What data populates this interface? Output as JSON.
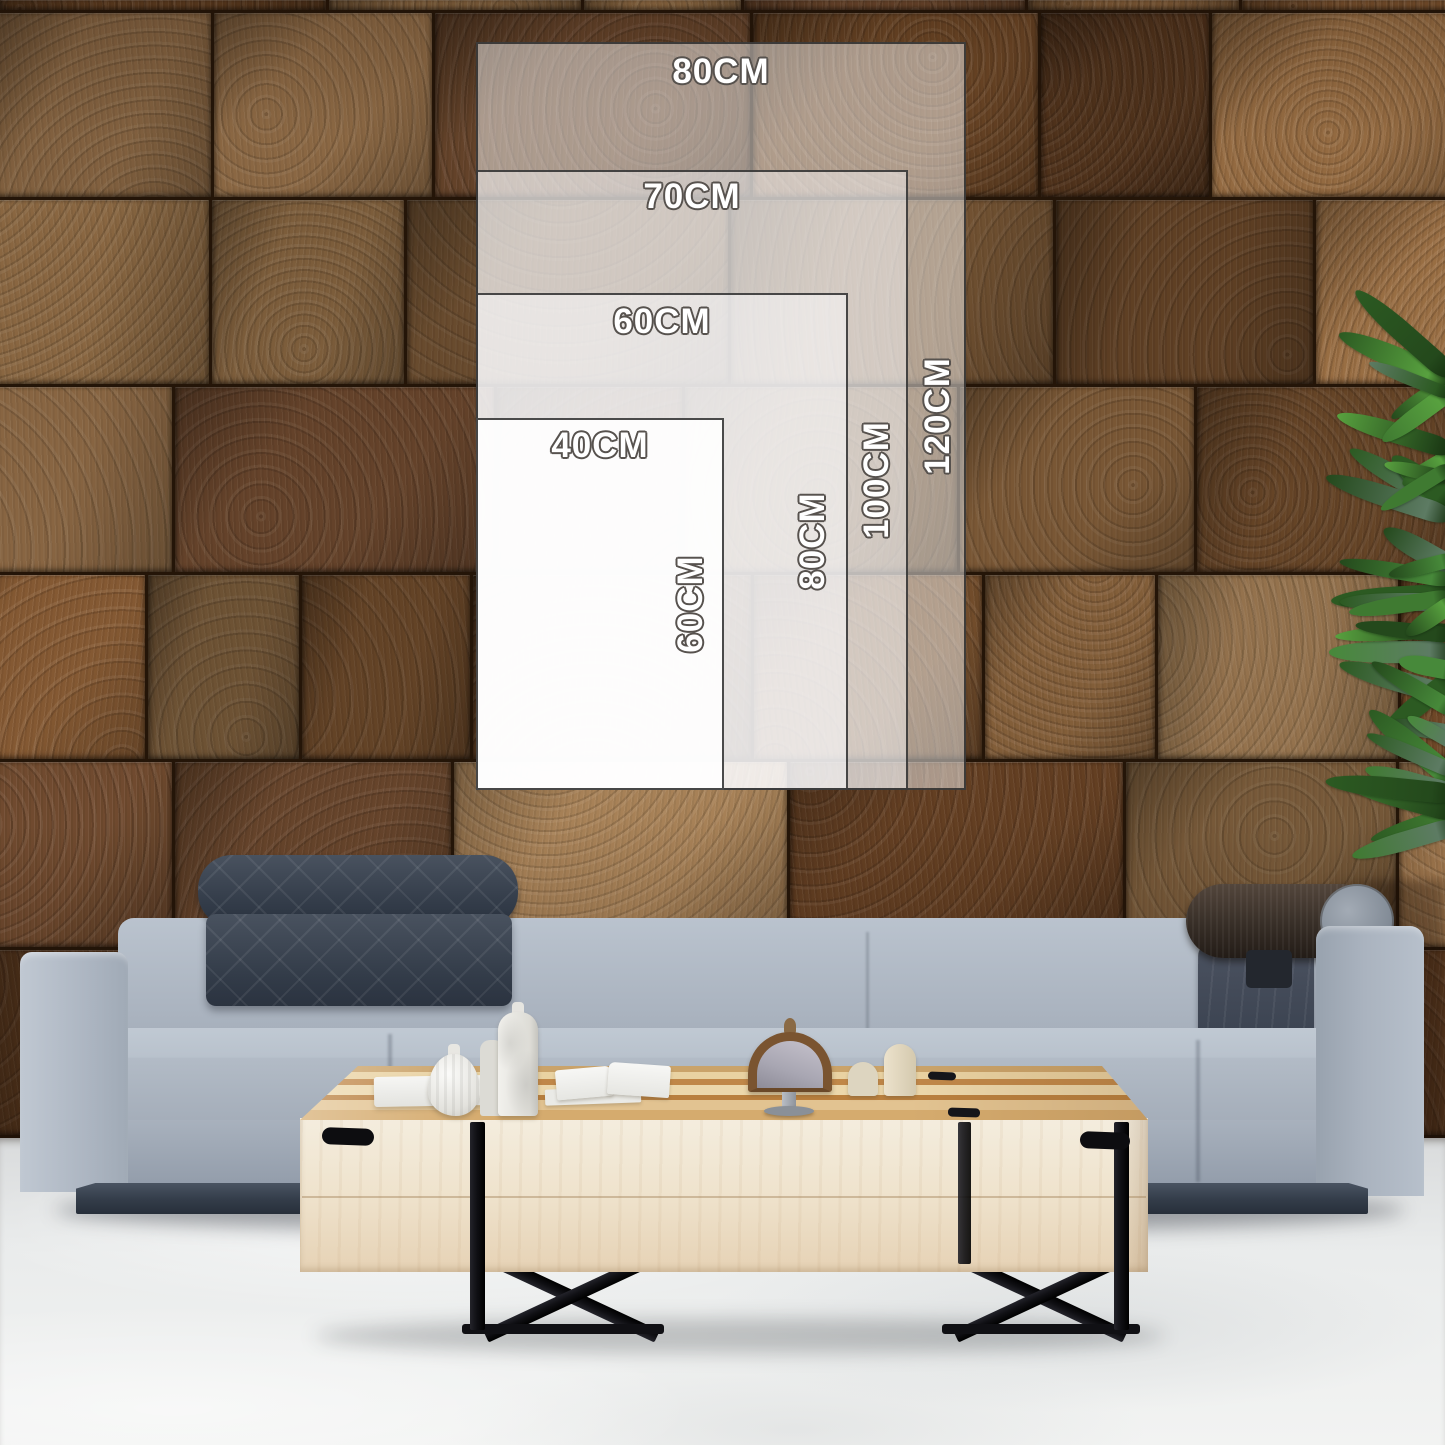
{
  "size_guide": {
    "unit": "CM",
    "sizes": [
      {
        "width_cm": 80,
        "height_cm": 120,
        "width_label": "80CM",
        "height_label": "120CM"
      },
      {
        "width_cm": 70,
        "height_cm": 100,
        "width_label": "70CM",
        "height_label": "100CM"
      },
      {
        "width_cm": 60,
        "height_cm": 80,
        "width_label": "60CM",
        "height_label": "80CM"
      },
      {
        "width_cm": 40,
        "height_cm": 60,
        "width_label": "40CM",
        "height_label": "60CM"
      }
    ]
  },
  "colors": {
    "label_fill": "#ffffff",
    "label_outline": "#57524e",
    "rect_border": "#2a2a2a",
    "wall_browns": [
      "#6e4a2a",
      "#7d5a37",
      "#5b3b20",
      "#8a6743",
      "#734c2b",
      "#65432a",
      "#80603d",
      "#57371e",
      "#96744e"
    ],
    "floor_gray": "#eaecec",
    "sofa_fabric": "#aab3bf",
    "sofa_base": "#333c49",
    "headrest_dark": "#3a4252",
    "bolster_brown": "#372e27",
    "table_wood_pale": "#efe3cd",
    "table_wood_streak": "#c08748",
    "leg_black": "#101014",
    "plant_greens": [
      "#3f7a31",
      "#2c5a22",
      "#58a13f",
      "#24491c",
      "#5d7b63",
      "#47893a"
    ]
  }
}
